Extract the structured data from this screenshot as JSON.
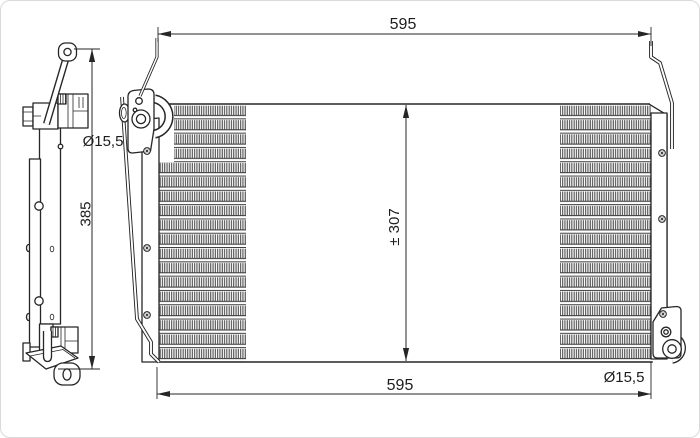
{
  "drawing": {
    "background": "#ffffff",
    "ink_color": "#262626",
    "dimensions": {
      "top_width": "595",
      "bottom_width": "595",
      "core_height": "± 307",
      "side_overall_height": "385",
      "top_port_diameter": "Ø15,5",
      "bottom_port_diameter": "Ø15,5"
    }
  }
}
